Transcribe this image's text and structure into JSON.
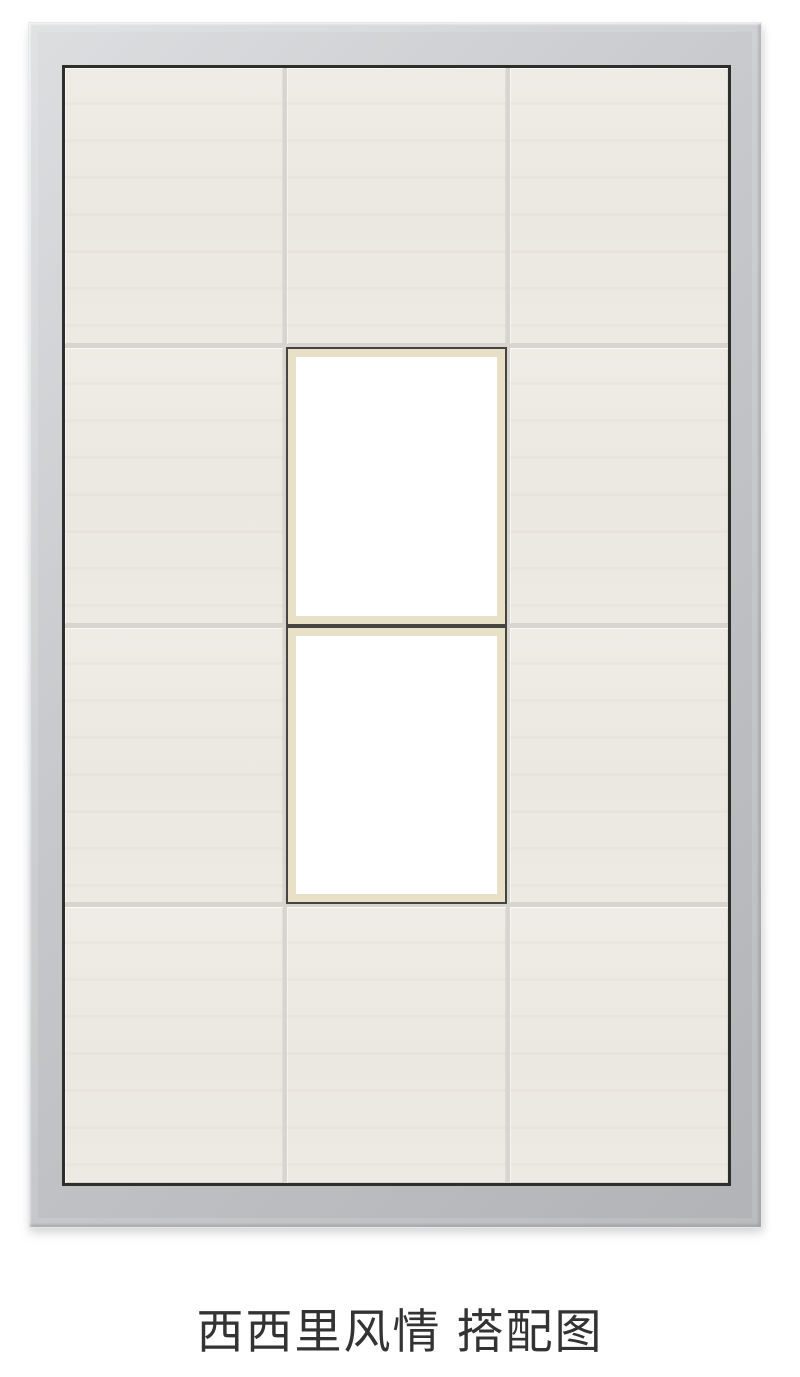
{
  "product": {
    "name": "西西里风情",
    "caption": "西西里风情 搭配图"
  },
  "display": {
    "grid": {
      "columns": 3,
      "rows": 4
    },
    "feature_tiles": {
      "count": 2,
      "grid_column": 2,
      "grid_rows": [
        2,
        3
      ]
    },
    "colors": {
      "background": "#ffffff",
      "frame_silver_light": "#dcdee0",
      "frame_silver_mid": "#c6c8cb",
      "frame_silver_dark": "#b1b3b6",
      "frame_inner_line": "#2e2e2a",
      "tile_beige": "#edeae3",
      "grout": "#d8d5ce",
      "feature_border": "#454440",
      "feature_mat": "#e9e1c7",
      "feature_fill": "#ffffff",
      "caption_text": "#333333"
    }
  }
}
